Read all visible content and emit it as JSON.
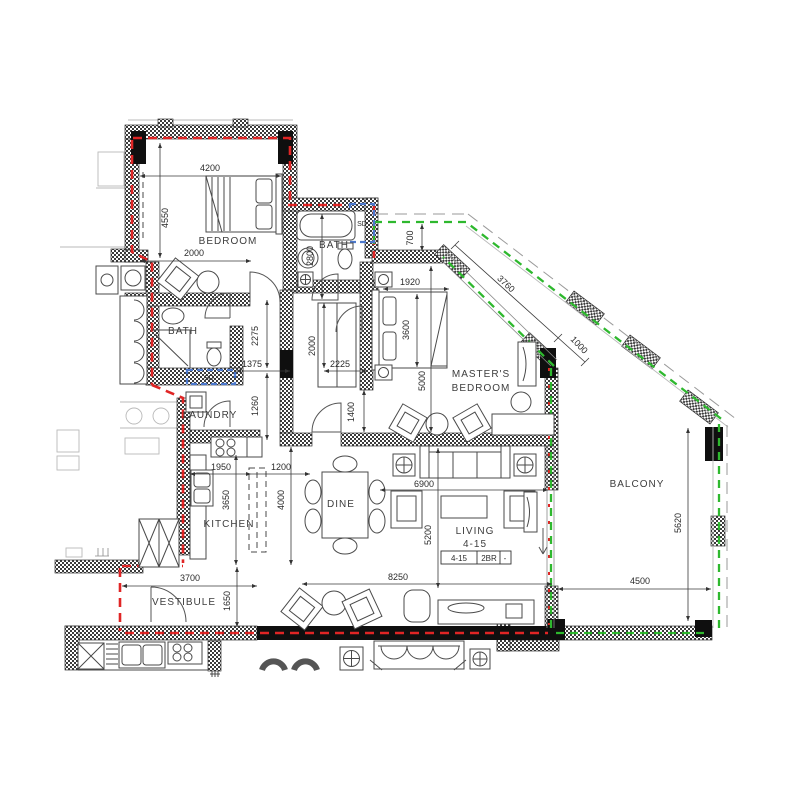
{
  "plan": {
    "rooms": {
      "bedroom": "BEDROOM",
      "bath_top": "BATH",
      "bath_left": "BATH",
      "laundry": "LAUNDRY",
      "kitchen": "KITCHEN",
      "vestibule": "VESTIBULE",
      "dine": "DINE",
      "living_line1": "LIVING",
      "living_line2": "4-15",
      "masters_line1": "MASTER'S",
      "masters_line2": "BEDROOM",
      "balcony": "BALCONY",
      "sd_top": "SD",
      "sd_left": "SD"
    },
    "tag": {
      "unit": "4-15",
      "type": "2BR",
      "dash": "-"
    },
    "dims": {
      "d4200": "4200",
      "d4550": "4550",
      "d2000_bedroom": "2000",
      "d2800": "2800",
      "d700": "700",
      "d1920": "1920",
      "d3600": "3600",
      "d5000": "5000",
      "d2275": "2275",
      "d1375": "1375",
      "d1260": "1260",
      "d2000_hall": "2000",
      "d2225": "2225",
      "d1400": "1400",
      "d1950": "1950",
      "d1200": "1200",
      "d3650": "3650",
      "d4000": "4000",
      "d6900": "6900",
      "d5200": "5200",
      "d8250": "8250",
      "d3700": "3700",
      "d1650": "1650",
      "d3760": "3760",
      "d1000": "1000",
      "d5620": "5620",
      "d4500": "4500"
    },
    "colors": {
      "red": "#e02525",
      "green": "#2eb82e",
      "blue": "#4d79cc"
    }
  }
}
